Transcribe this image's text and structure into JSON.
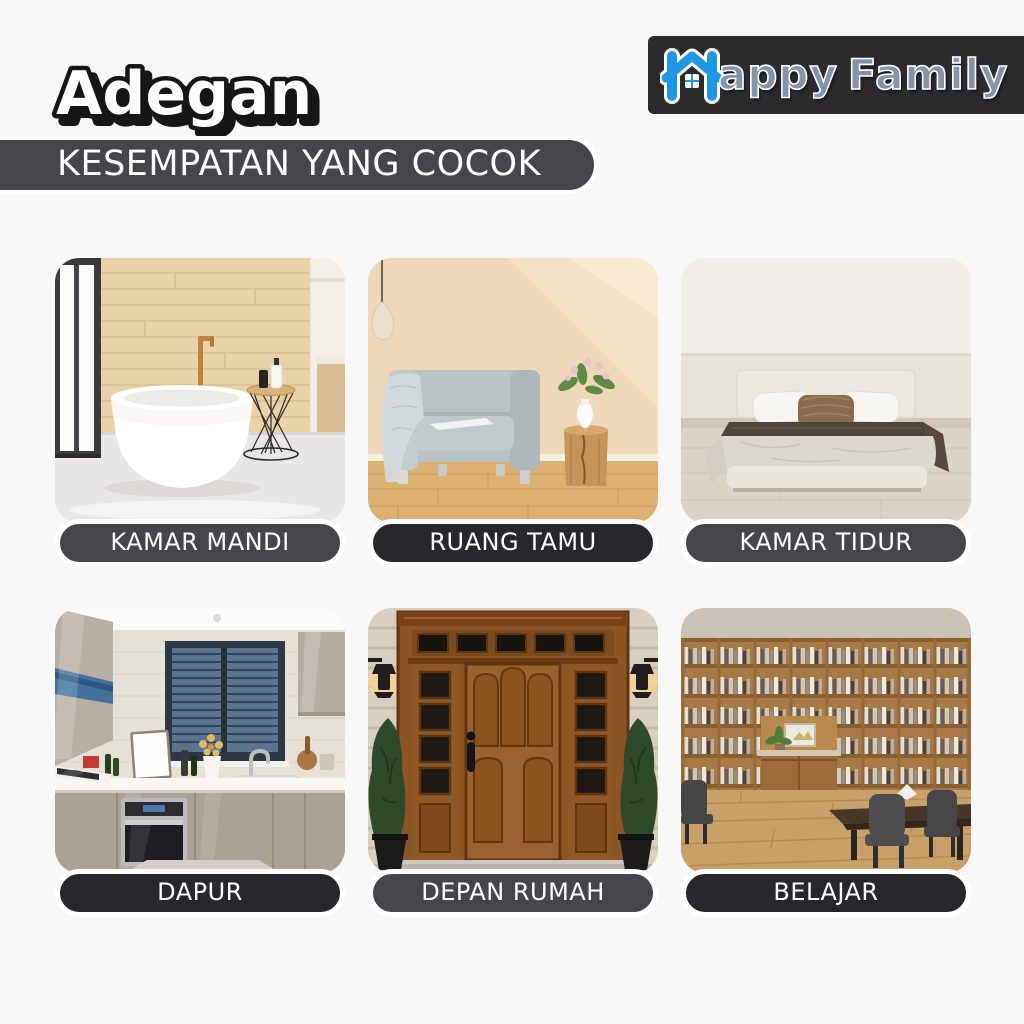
{
  "header": {
    "title": "Adegan",
    "subtitle": "KESEMPATAN YANG COCOK"
  },
  "logo": {
    "word1": "appy",
    "word2": "Family"
  },
  "cards": [
    {
      "id": "kamar-mandi",
      "label": "KAMAR MANDI"
    },
    {
      "id": "ruang-tamu",
      "label": "RUANG TAMU"
    },
    {
      "id": "kamar-tidur",
      "label": "KAMAR TIDUR"
    },
    {
      "id": "dapur",
      "label": "DAPUR"
    },
    {
      "id": "depan-rumah",
      "label": "DEPAN RUMAH"
    },
    {
      "id": "belajar",
      "label": "BELAJAR"
    }
  ],
  "colors": {
    "page_background": "#f7f7f8",
    "banner_background": "#47444a",
    "logo_background": "#2c2a2d",
    "brand_blue": "#2196e3",
    "brand_gray_blue": "#8493a8",
    "pill_light": "#48454a",
    "pill_dark": "#29272b",
    "text_white": "#ffffff"
  }
}
